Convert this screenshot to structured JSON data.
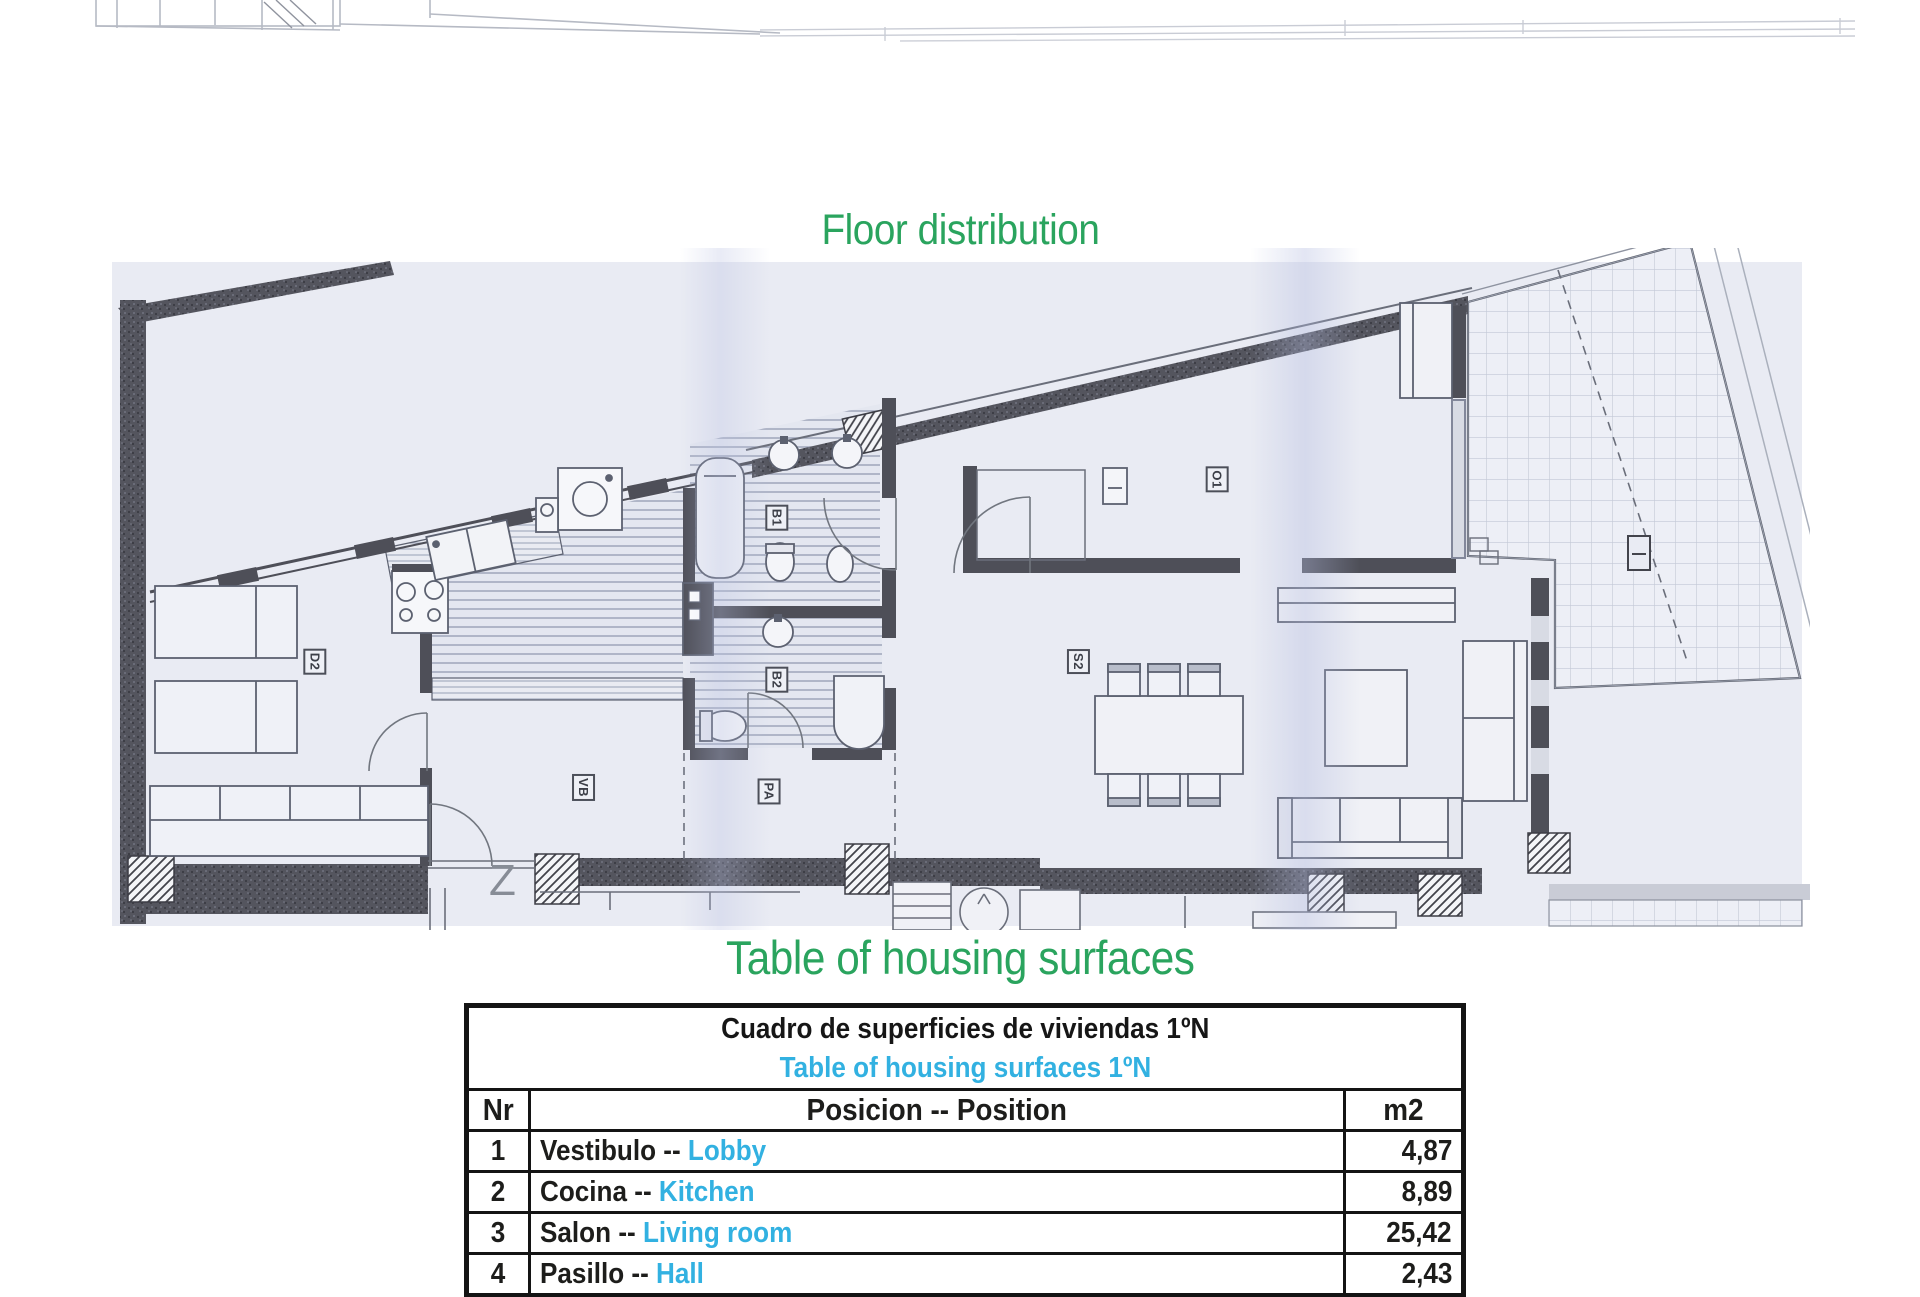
{
  "headings": {
    "floor": "Floor distribution",
    "table": "Table of housing surfaces",
    "color": "#2aa45e"
  },
  "surface_table": {
    "title_es": "Cuadro de superficies de viviendas 1ºN",
    "title_en": "Table of housing surfaces 1ºN",
    "columns": {
      "nr": "Nr",
      "position": "Posicion -- Position",
      "area": "m2"
    },
    "rows": [
      {
        "nr": "1",
        "position_es": "Vestibulo --",
        "position_en": "Lobby",
        "m2": "4,87"
      },
      {
        "nr": "2",
        "position_es": "Cocina --",
        "position_en": " Kitchen",
        "m2": "8,89"
      },
      {
        "nr": "3",
        "position_es": "Salon --",
        "position_en": "Living room",
        "m2": "25,42"
      },
      {
        "nr": "4",
        "position_es": "Pasillo --",
        "position_en": "Hall",
        "m2": "2,43"
      }
    ],
    "accent_color": "#32b1e1",
    "text_color": "#1d1d1b"
  },
  "floor_plan": {
    "north_mark": "Z",
    "labels": [
      {
        "text": "D2",
        "x": 302,
        "y": 650
      },
      {
        "text": "B1",
        "x": 764,
        "y": 506
      },
      {
        "text": "B2",
        "x": 764,
        "y": 668
      },
      {
        "text": "VB",
        "x": 570,
        "y": 776
      },
      {
        "text": "PA",
        "x": 756,
        "y": 780
      },
      {
        "text": "S2",
        "x": 1066,
        "y": 650
      },
      {
        "text": "O1",
        "x": 1204,
        "y": 468
      }
    ]
  }
}
